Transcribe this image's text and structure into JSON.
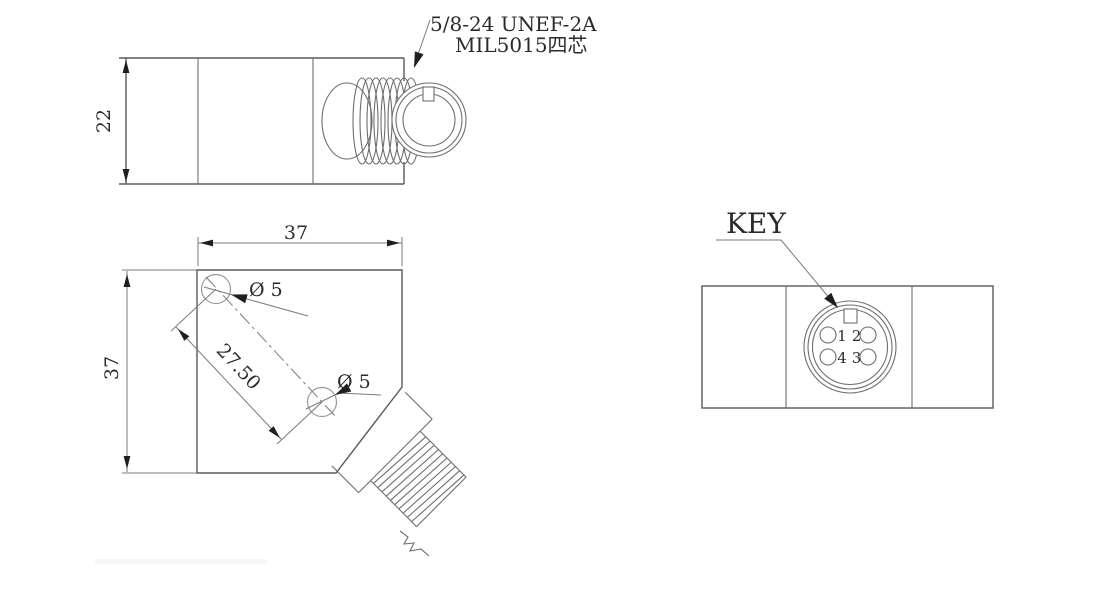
{
  "drawing": {
    "background": "#ffffff",
    "line_color": "#5a5a5a",
    "dim_line_color": "#7b7b7b",
    "arrow_color": "#1f1f1f",
    "text_color": "#2b2b2b",
    "side_view": {
      "height_dim": "22",
      "thread_note_line1": "5/8-24 UNEF-2A",
      "thread_note_line2": "MIL5015四芯"
    },
    "top_view": {
      "width_dim": "37",
      "height_dim": "37",
      "hole_spacing_dim": "27.50",
      "hole1_dia_label": "Ø 5",
      "hole2_dia_label": "Ø 5"
    },
    "connector_view": {
      "key_label": "KEY",
      "pin_labels": [
        "1",
        "2",
        "4",
        "3"
      ]
    }
  }
}
